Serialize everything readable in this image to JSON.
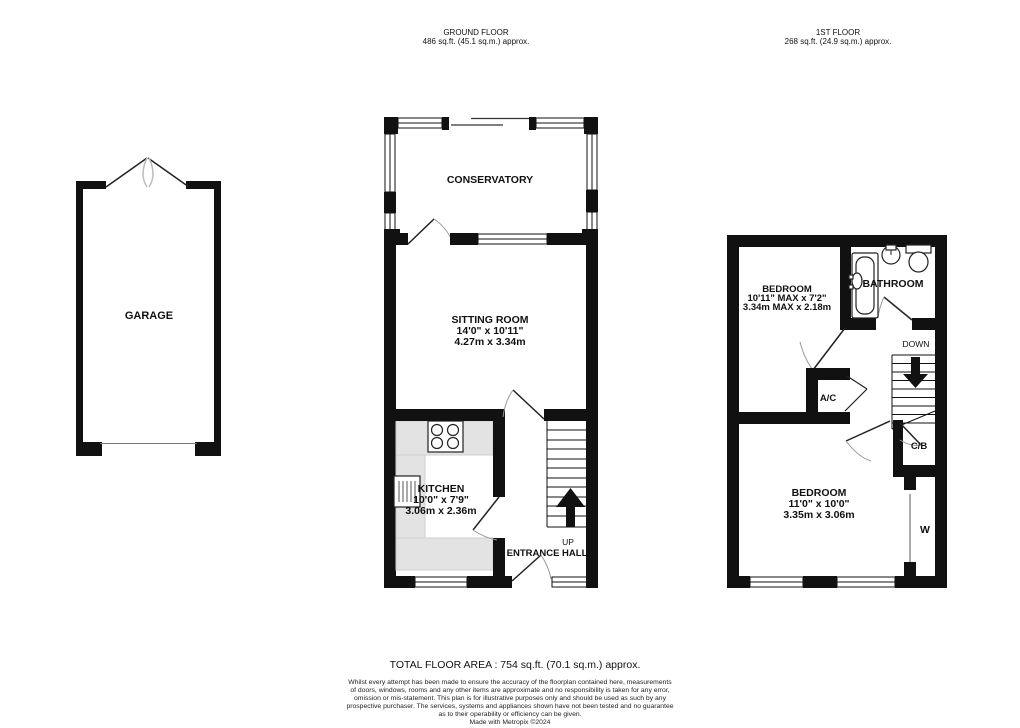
{
  "headers": {
    "ground_floor": {
      "title": "GROUND FLOOR",
      "area": "486 sq.ft. (45.1 sq.m.) approx."
    },
    "first_floor": {
      "title": "1ST FLOOR",
      "area": "268 sq.ft. (24.9 sq.m.) approx."
    }
  },
  "rooms": {
    "garage": {
      "name": "GARAGE"
    },
    "conservatory": {
      "name": "CONSERVATORY"
    },
    "sitting_room": {
      "name": "SITTING ROOM",
      "dims_imperial": "14'0\" x 10'11\"",
      "dims_metric": "4.27m x 3.34m"
    },
    "kitchen": {
      "name": "KITCHEN",
      "dims_imperial": "10'0\" x 7'9\"",
      "dims_metric": "3.06m x 2.36m"
    },
    "entrance_hall": {
      "name": "ENTRANCE HALL",
      "up_label": "UP"
    },
    "bedroom_1": {
      "name": "BEDROOM",
      "dims_imperial": "10'11\" MAX x 7'2\"",
      "dims_metric": "3.34m MAX x 2.18m"
    },
    "bathroom": {
      "name": "BATHROOM"
    },
    "bedroom_2": {
      "name": "BEDROOM",
      "dims_imperial": "11'0\" x 10'0\"",
      "dims_metric": "3.35m x 3.06m"
    },
    "landing": {
      "down_label": "DOWN",
      "ac_label": "A/C",
      "cb_label": "C/B",
      "wardrobe_label": "W"
    }
  },
  "footer": {
    "total_area": "TOTAL FLOOR AREA : 754 sq.ft. (70.1 sq.m.) approx.",
    "disclaimer_lines": [
      "Whilst every attempt has been made to ensure the accuracy of the floorplan contained here, measurements",
      "of doors, windows, rooms and any other items are approximate and no responsibility is taken for any error,",
      "omission or mis-statement. This plan is for illustrative purposes only and should be used as such by any",
      "prospective purchaser. The services, systems and appliances shown have not been tested and no guarantee",
      "as to their operability or efficiency can be given.",
      "Made with Metropix ©2024"
    ]
  },
  "colors": {
    "wall": "#111111",
    "counter": "#e3e3e3",
    "swing_arc": "#999999"
  }
}
